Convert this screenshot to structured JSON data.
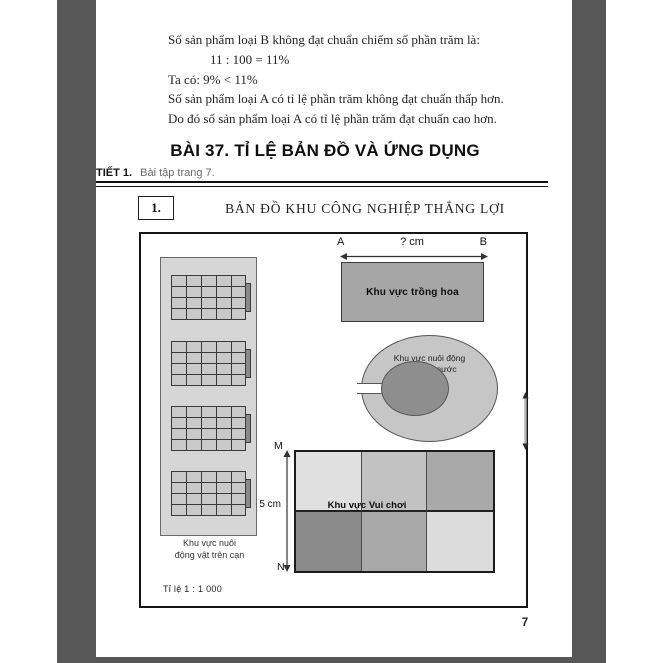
{
  "solution": {
    "lines": [
      "Số sản phẩm loại B không đạt chuẩn chiếm số phần trăm là:",
      "11 : 100 = 11%",
      "Ta có: 9% < 11%",
      "Số sản phẩm loại A có tỉ lệ phần trăm không đạt chuẩn thấp hơn.",
      "Do đó số sản phẩm loại A có tỉ lệ phần trăm đạt chuẩn cao hơn."
    ]
  },
  "lesson": {
    "title": "BÀI 37. TỈ LỆ BẢN ĐỒ VÀ ỨNG DỤNG",
    "section_label": "TIẾT 1.",
    "section_note": "Bài tập trang 7.",
    "exercise": {
      "number": "1.",
      "title": "BẢN ĐỒ KHU CÔNG NGHIỆP THẮNG LỢI"
    }
  },
  "map": {
    "scale_label": "Tỉ lệ 1 : 1 000",
    "flower_area": {
      "label": "Khu vực trồng hoa",
      "endpoint_left": "A",
      "endpoint_right": "B",
      "width_label": "? cm"
    },
    "pond_area": {
      "label_line1": "Khu vực nuôi động",
      "label_line2": "vật dưới nước"
    },
    "land_area": {
      "label_line1": "Khu vực nuôi",
      "label_line2": "động vật trên cạn"
    },
    "play_area": {
      "label": "Khu vực Vui chơi",
      "endpoint_top": "M",
      "endpoint_bottom": "N",
      "height_label": "5 cm",
      "cell_colors": [
        "#e0e0e0",
        "#c2c2c2",
        "#a9a9a9",
        "#8a8a8a",
        "#a9a9a9",
        "#dcdcdc"
      ]
    }
  },
  "page": {
    "number": "7"
  },
  "colors": {
    "backdrop_bar": "#575757",
    "flower_fill": "#a6a6a6",
    "pond_fill": "#c6c6c6",
    "pond_island_fill": "#8e8e8e",
    "land_fill": "#d6d6d6",
    "cage_fill": "#c9c9c9"
  }
}
